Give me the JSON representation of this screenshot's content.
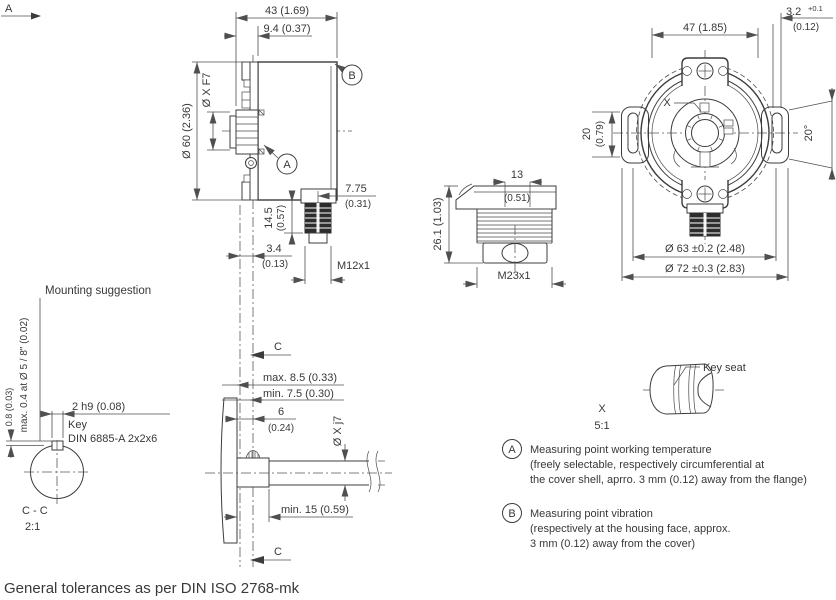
{
  "meta": {
    "view_arrow": "A",
    "mounting_heading": "Mounting suggestion",
    "footer": "General tolerances as per DIN ISO 2768-mk"
  },
  "side_view": {
    "dim_depth": "43 (1.69)",
    "dim_flange_depth": "9.4 (0.37)",
    "dim_body_dia": "Ø 60 (2.36)",
    "dim_shaft_bore": "Ø X F7",
    "balloon_a": "A",
    "balloon_b": "B",
    "dim_conn_pos_mm": "7.75",
    "dim_conn_pos_in": "(0.31)",
    "dim_conn_len_mm": "14.5",
    "dim_conn_len_in": "(0.57)",
    "dim_face_mm": "3.4",
    "dim_face_in": "(0.13)",
    "thread": "M12x1"
  },
  "front_view": {
    "dim_width": "47 (1.85)",
    "dim_step_mm": "3.2",
    "dim_step_tol": "+0.1",
    "dim_step_in": "(0.12)",
    "dim_slot_mm": "20",
    "dim_slot_in": "(0.79)",
    "dim_angle": "20°",
    "detail_mark": "X",
    "dim_bolt_circle": "Ø 63 ±0.2 (2.48)",
    "dim_outer": "Ø 72 ±0.3 (2.83)"
  },
  "connector_view": {
    "dim_width_mm": "13",
    "dim_width_in": "(0.51)",
    "dim_len": "26.1 (1.03)",
    "thread": "M23x1"
  },
  "mounting_view": {
    "section_mark_top": "C",
    "section_mark_bottom": "C",
    "dim_max": "max. 8.5 (0.33)",
    "dim_min": "min. 7.5 (0.30)",
    "dim_key_len_mm": "6",
    "dim_key_len_in": "(0.24)",
    "dim_shaft_fit": "Ø X j7",
    "dim_depth": "min. 15 (0.59)"
  },
  "section_view": {
    "dim_runout": "max. 0.4 at Ø 5 / 8\" (0.02)",
    "dim_key_height": "0.8 (0.03)",
    "dim_key_width": "2 h9 (0.08)",
    "key_label": "Key",
    "key_spec": "DIN 6885-A 2x2x6",
    "section_name": "C - C",
    "scale": "2:1"
  },
  "detail_view": {
    "label": "Key seat",
    "mark": "X",
    "scale": "5:1"
  },
  "notes": {
    "a_id": "A",
    "a_line1": "Measuring point working temperature",
    "a_line2": "(freely selectable, respectively circumferential at",
    "a_line3": "the cover shell, aprro. 3 mm (0.12) away from the flange)",
    "b_id": "B",
    "b_line1": "Measuring point vibration",
    "b_line2": "(respectively at the housing face, approx.",
    "b_line3": "3 mm (0.12) away from the cover)"
  }
}
